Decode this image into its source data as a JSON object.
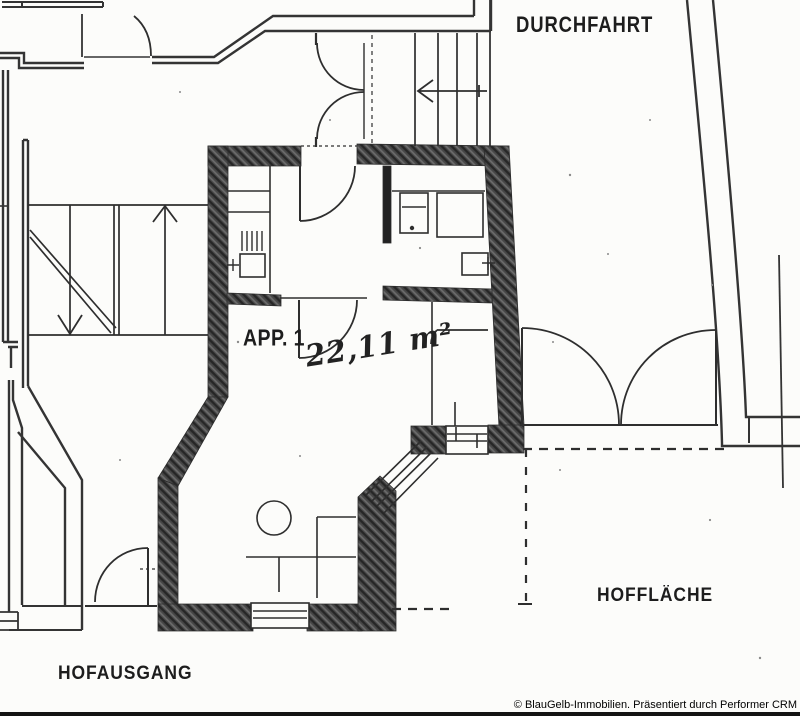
{
  "title": "Grundriss Scan Appartement 1",
  "colors": {
    "paper": "#fcfcfa",
    "ink": "#2e2e2e",
    "wall_fill": "#424242",
    "footer_bar": "#131313"
  },
  "labels": {
    "durchfahrt": "DURCHFAHRT",
    "apartment": "APP. 1",
    "area": "22,11 m²",
    "hofflaeche": "HOFFLÄCHE",
    "hofausgang": "HOFAUSGANG"
  },
  "icons": {
    "stair_up_arrow": "↑",
    "stair_down_arrow": "↓",
    "stair_left_arrow": "←"
  },
  "footer": {
    "copyright": "© BlauGelb-Immobilien. Präsentiert durch Performer CRM"
  }
}
